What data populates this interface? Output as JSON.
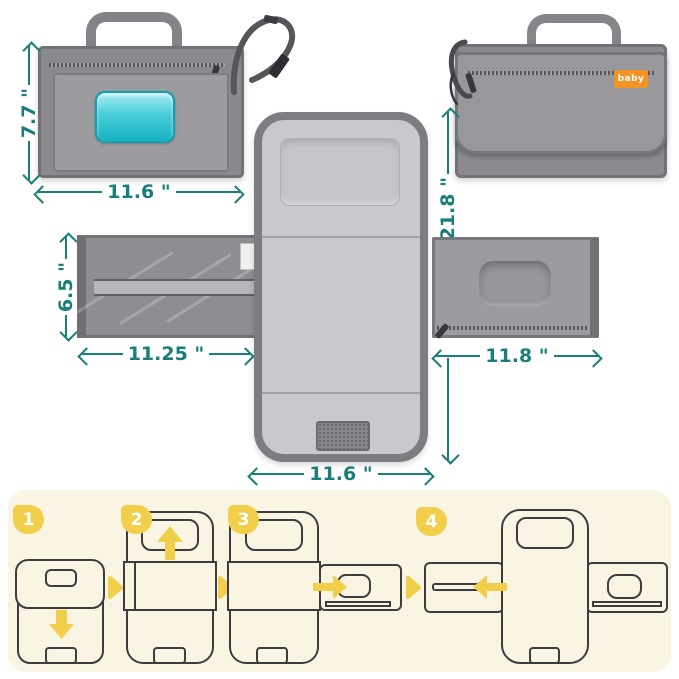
{
  "brand": {
    "label": "baby"
  },
  "dimensions": {
    "bag_height": "7.7 \"",
    "bag_width": "11.6 \"",
    "pad_length": "21.8 \"",
    "mesh_pocket_height": "6.5 \"",
    "mesh_pocket_width": "11.25 \"",
    "side_pocket_width": "11.8 \"",
    "pad_width": "11.6 \""
  },
  "fold_steps": {
    "labels": [
      "1",
      "2",
      "3",
      "4"
    ]
  },
  "colors": {
    "dimension_teal": "#187E79",
    "step_yellow": "#F2CF4B",
    "panel_cream": "#FAF5E2",
    "wipes_window_teal": "#3EC8D5",
    "brand_tag_orange": "#F39422",
    "fabric_gray": "#96969A"
  }
}
